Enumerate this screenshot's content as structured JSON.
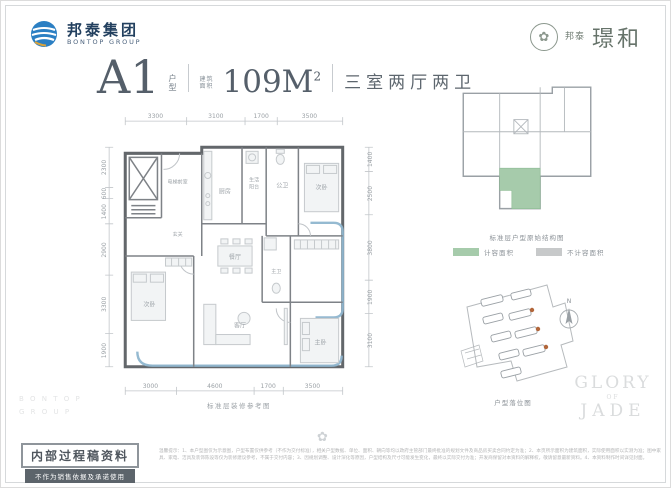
{
  "brand": {
    "left": {
      "cn": "邦泰集团",
      "en": "BONTOP GROUP"
    },
    "right": {
      "prefix": "邦泰",
      "name": "璟和"
    }
  },
  "title": {
    "unit": "A1",
    "unit_label_1": "户",
    "unit_label_2": "型",
    "area_label_1": "建筑",
    "area_label_2": "面积",
    "area_value": "109M",
    "area_sup": "2",
    "layout": "三室两厅两卫"
  },
  "floorplan": {
    "caption": "标准层装修参考图",
    "dims_top": [
      "3300",
      "3100",
      "1700",
      "3500"
    ],
    "dims_bottom": [
      "3000",
      "4600",
      "1700",
      "3500"
    ],
    "dims_left": [
      "2300",
      "600",
      "1400",
      "2900",
      "3300",
      "1900"
    ],
    "dims_right": [
      "1400",
      "2500",
      "3800",
      "1900",
      "3100"
    ],
    "rooms": {
      "elevator": "电梯前室",
      "foyer": "玄关",
      "kitchen": "厨房",
      "service_balcony_1": "生活",
      "service_balcony_2": "阳台",
      "guest_bath": "公卫",
      "bedroom_top": "次卧",
      "dining": "餐厅",
      "living": "客厅",
      "master_bath": "主卫",
      "master_bedroom": "主卧",
      "bedroom_left": "次卧"
    }
  },
  "keyplan": {
    "caption": "标准层户型原始结构图",
    "legend": [
      {
        "label": "计容面积",
        "color": "#a6cbab"
      },
      {
        "label": "不计容面积",
        "color": "#c7c9ca"
      }
    ]
  },
  "siteplan": {
    "caption": "户型落位图",
    "compass": "N"
  },
  "watermarks": {
    "glory_1": "GLORY",
    "glory_2": "OF",
    "glory_3": "JADE",
    "side_1": "B O N T O P",
    "side_2": "G R O U P",
    "ornament": "✿",
    "medallion": "✿"
  },
  "stamp": {
    "title": "内部过程稿资料",
    "subtitle": "不作为销售依据及承诺使用"
  },
  "disclaimer": "温馨提示：1、本户型图仅为示意图，户型布置仅供参考（不作为交付标准），相关户型数据、单位、面积、朝向等均以政府主管部门最终批准的规划文件及商品房买卖合同约定为准；2、本页所示面积为建筑面积，实际使用面积以实测为准；图中家具、家电、洁具及装饰陈设等仅为装修建议参考，不属于交付内容；3、因规划调整、设计深化等原因，户型结构及尺寸可能发生变化，最终以实际交付为准；开发商保留对本资料的解释权，敬请留意最新资料。4、本资料制作时间详见封面。"
}
